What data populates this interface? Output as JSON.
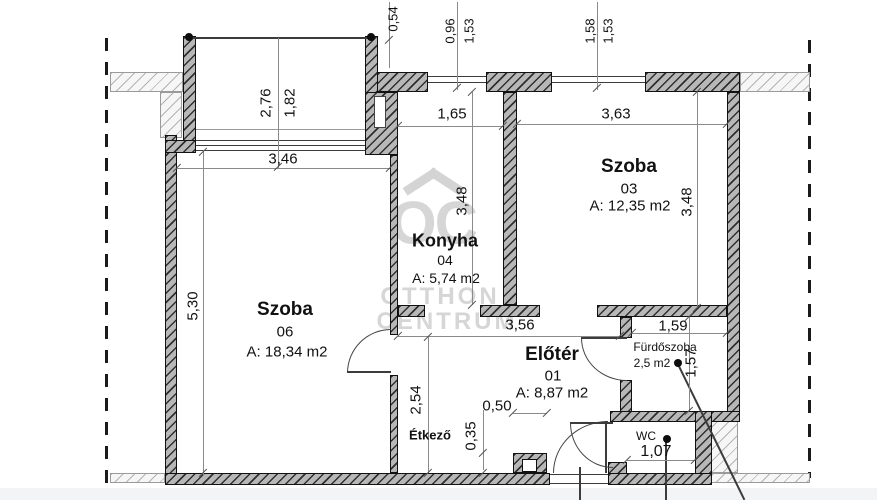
{
  "watermark": {
    "logo_text": "OC",
    "line1": "OTTHON",
    "line2": "CENTRUM"
  },
  "rooms": {
    "szoba06": {
      "name": "Szoba",
      "number": "06",
      "area": "A: 18,34 m2"
    },
    "konyha": {
      "name": "Konyha",
      "number": "04",
      "area": "A: 5,74 m2"
    },
    "szoba03": {
      "name": "Szoba",
      "number": "03",
      "area": "A: 12,35 m2"
    },
    "eloter": {
      "name": "Előtér",
      "number": "01",
      "area": "A: 8,87 m2"
    },
    "furdoszoba": {
      "name": "Fürdőszoba",
      "area": "2,5 m2"
    },
    "wc": {
      "name": "WC"
    },
    "etkezo": {
      "name": "Étkező"
    }
  },
  "dims": {
    "d054": "0,54",
    "d096": "0,96",
    "d153a": "1,53",
    "d158": "1,58",
    "d153b": "1,53",
    "d276": "2,76",
    "d182": "1,82",
    "d346": "3,46",
    "d530": "5,30",
    "d165": "1,65",
    "d363": "3,63",
    "d348k": "3,48",
    "d348s": "3,48",
    "d356": "3,56",
    "d254": "2,54",
    "d050": "0,50",
    "d035": "0,35",
    "d159": "1,59",
    "d157": "1,57",
    "d107": "1,07"
  }
}
